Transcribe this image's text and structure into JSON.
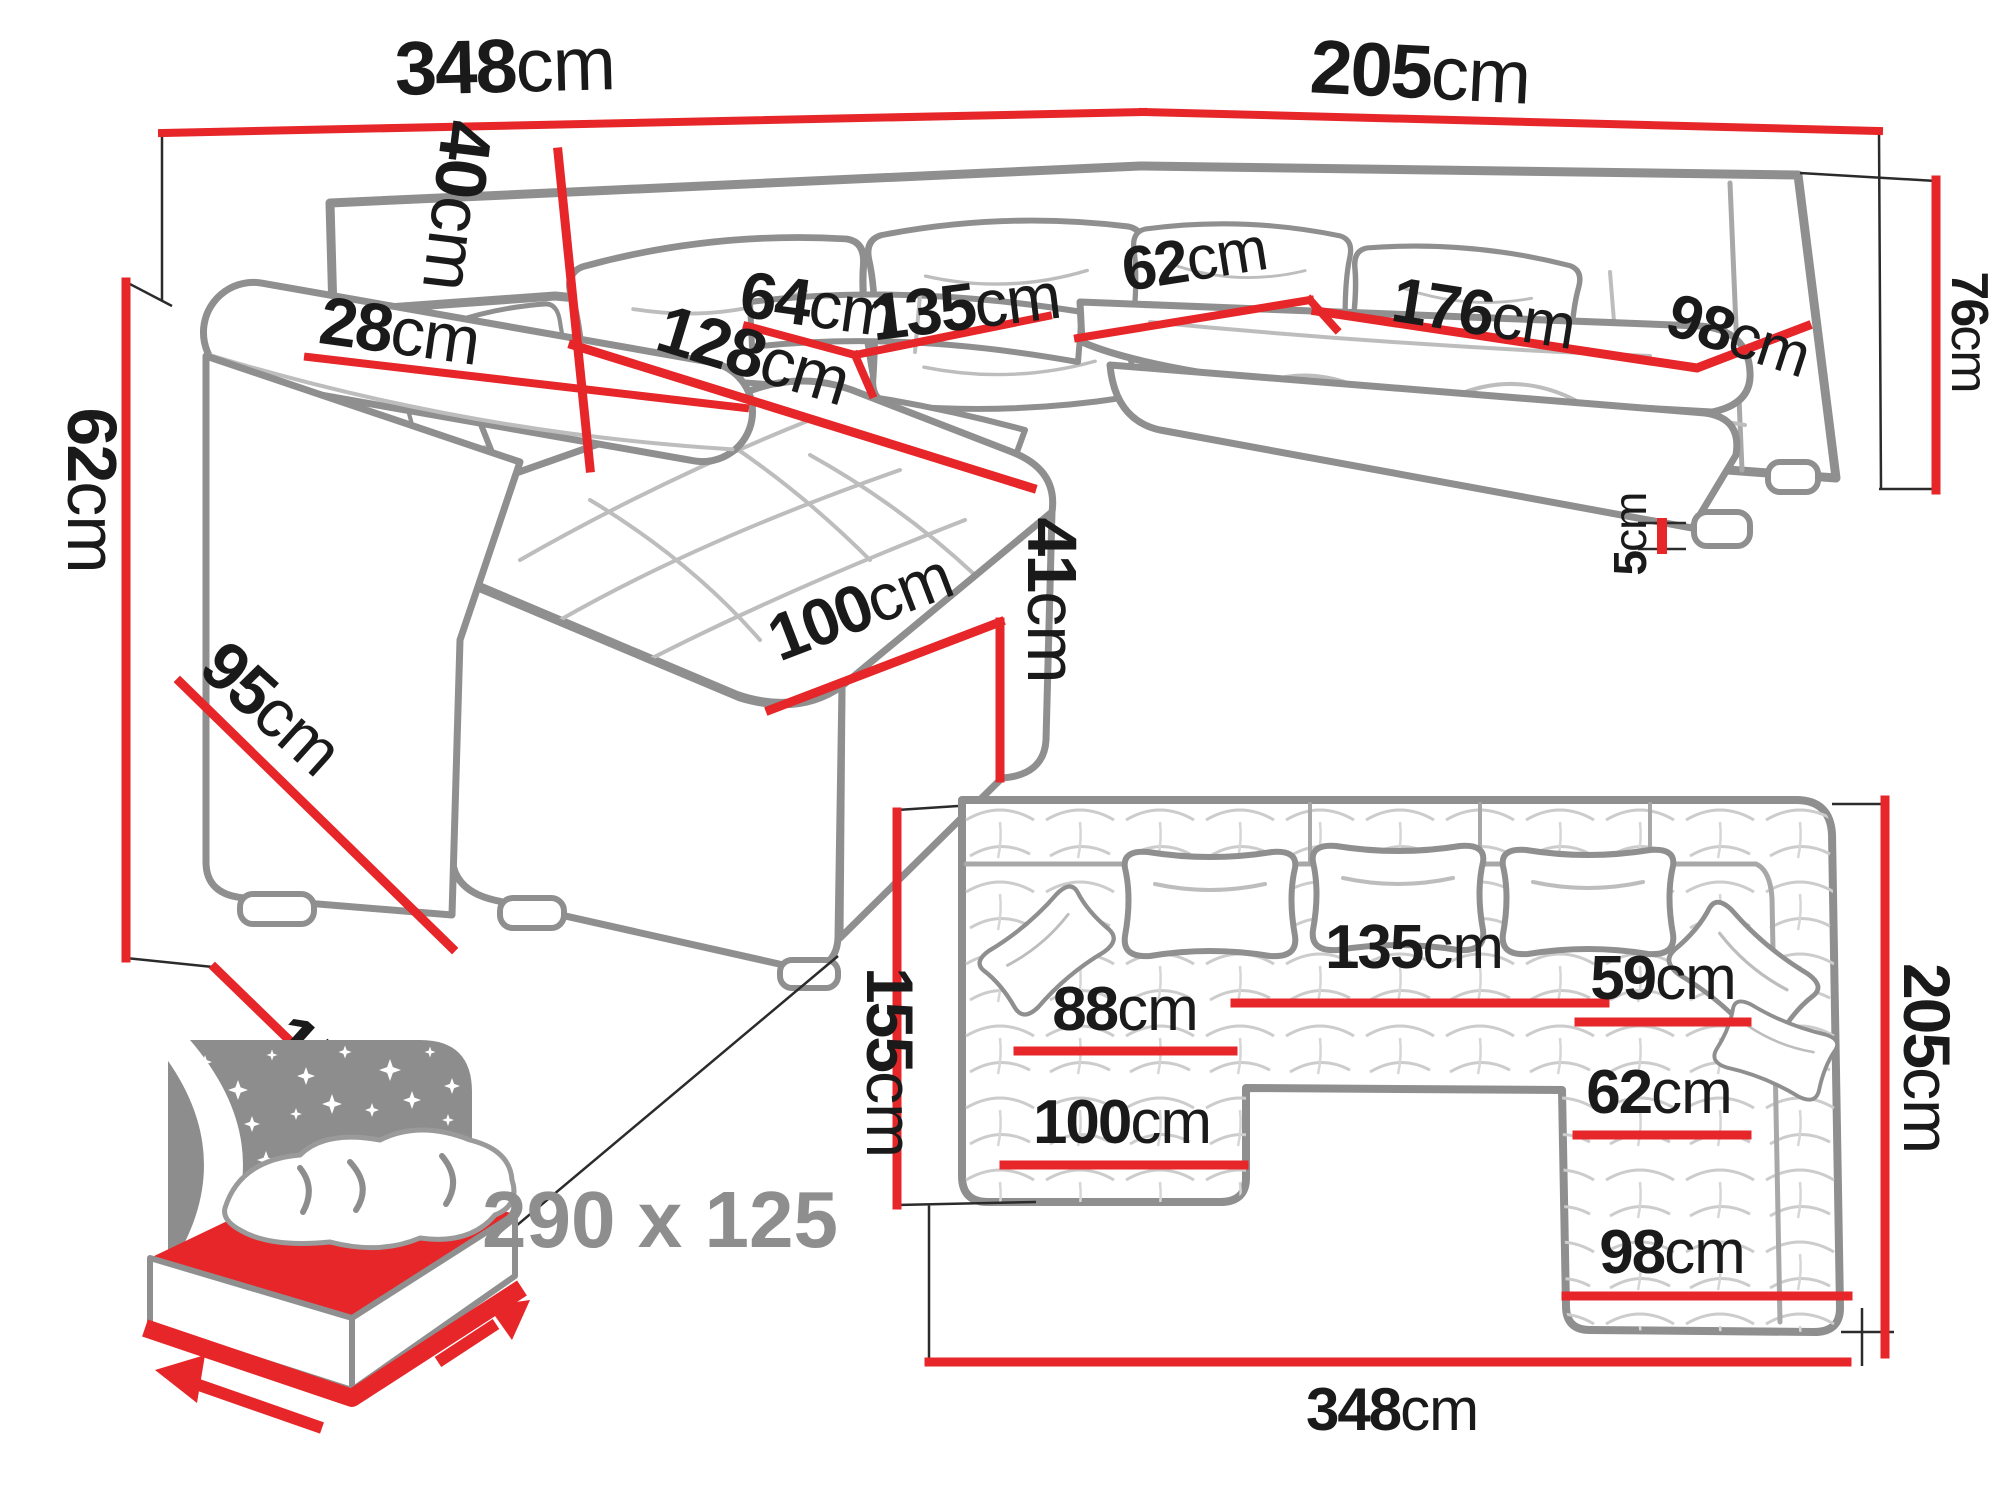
{
  "colors": {
    "dimension_red": "#e62629",
    "sketch_gray": "#8f8f8f",
    "text_black": "#1a1a1a",
    "label_gray": "#8e8e8e"
  },
  "perspective": {
    "back_width": {
      "v": "348",
      "u": "cm"
    },
    "side_depth": {
      "v": "205",
      "u": "cm"
    },
    "arm_height": {
      "v": "62",
      "u": "cm"
    },
    "arm_depth": {
      "v": "95",
      "u": "cm"
    },
    "chaise_depth_total": {
      "v": "155",
      "u": "cm"
    },
    "arm_width": {
      "v": "28",
      "u": "cm"
    },
    "cushion_height": {
      "v": "40",
      "u": "cm"
    },
    "seat_depth": {
      "v": "64",
      "u": "cm"
    },
    "center_seat_width": {
      "v": "135",
      "u": "cm"
    },
    "chaise_length": {
      "v": "128",
      "u": "cm"
    },
    "chaise_width": {
      "v": "100",
      "u": "cm"
    },
    "seat_height": {
      "v": "41",
      "u": "cm"
    },
    "right_seat_depth": {
      "v": "62",
      "u": "cm"
    },
    "right_seat_length": {
      "v": "176",
      "u": "cm"
    },
    "right_seat_width": {
      "v": "98",
      "u": "cm"
    },
    "backrest_height": {
      "v": "76",
      "u": "cm"
    },
    "leg_height": {
      "v": "5",
      "u": "cm"
    }
  },
  "plan": {
    "chaise_depth": {
      "v": "155",
      "u": "cm"
    },
    "center_seat_width": {
      "v": "135",
      "u": "cm"
    },
    "chaise_inner_length": {
      "v": "88",
      "u": "cm"
    },
    "right_inner_top_width": {
      "v": "59",
      "u": "cm"
    },
    "right_inner_width": {
      "v": "62",
      "u": "cm"
    },
    "chaise_width": {
      "v": "100",
      "u": "cm"
    },
    "right_bottom_width": {
      "v": "98",
      "u": "cm"
    },
    "total_width": {
      "v": "348",
      "u": "cm"
    },
    "total_depth": {
      "v": "205",
      "u": "cm"
    }
  },
  "sleeping": {
    "size_label": "290 x 125"
  }
}
